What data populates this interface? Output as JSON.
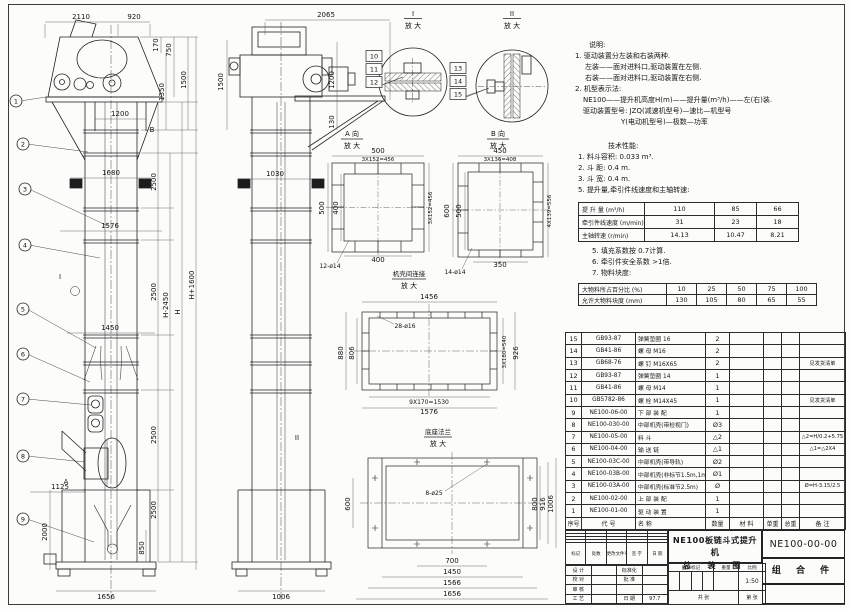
{
  "notes": {
    "title": "说明:",
    "lines": [
      {
        "t": "1. 驱动装置分左装和右装两种.",
        "i": 0
      },
      {
        "t": "左装——面对进料口,驱动装置在左侧.",
        "i": 10
      },
      {
        "t": "右装——面对进料口,驱动装置在右侧.",
        "i": 10
      },
      {
        "t": "2. 机型表示法:",
        "i": 0
      },
      {
        "t": "NE100——提升机高度H(m)——提升量(m³/h)——左(右)装.",
        "i": 8
      },
      {
        "t": "驱动装置型号: JZQ(减速机型号)—速比—机型号",
        "i": 8
      },
      {
        "t": "Y(电动机型号)—极数—功率",
        "i": 46
      }
    ]
  },
  "tech": {
    "title": "技术性能:",
    "lines_before": [
      {
        "t": "1. 料斗容积: 0.033 m³.",
        "i": 0
      },
      {
        "t": "2. 斗  距: 0.4 m.",
        "i": 0
      },
      {
        "t": "3. 斗  宽: 0.4 m.",
        "i": 0
      },
      {
        "t": "5. 提升量,牵引件线速度和主轴转速:",
        "i": 0
      }
    ],
    "lines_mid": [
      {
        "t": "5. 填充系数按 0.7计算.",
        "i": 0
      },
      {
        "t": "6. 牵引件安全系数 >1倍.",
        "i": 0
      },
      {
        "t": "7. 物料块度:",
        "i": 0
      }
    ]
  },
  "chart_data": [
    {
      "type": "table",
      "title": "提升量,牵引件线速度和主轴转速",
      "rows": [
        {
          "label": "提 升 量  (m³/h)",
          "values": [
            "110",
            "85",
            "66"
          ]
        },
        {
          "label": "牵引件线速度 (m/min)",
          "values": [
            "31",
            "23",
            "18"
          ]
        },
        {
          "label": "主轴转速  (r/min)",
          "values": [
            "14.13",
            "10.47",
            "8.21"
          ]
        }
      ]
    },
    {
      "type": "table",
      "title": "物料块度",
      "rows": [
        {
          "label": "大物料所占百分比 (%)",
          "values": [
            "10",
            "25",
            "50",
            "75",
            "100"
          ]
        },
        {
          "label": "允许大物料块度 (mm)",
          "values": [
            "130",
            "105",
            "80",
            "65",
            "55"
          ]
        }
      ]
    }
  ],
  "parts": {
    "headers": [
      "序号",
      "代  号",
      "名    称",
      "数量",
      "材  料",
      "单重",
      "总重",
      "备  注"
    ],
    "rows": [
      [
        "15",
        "GB93-87",
        "弹簧垫圈 16",
        "2",
        "",
        "",
        "",
        ""
      ],
      [
        "14",
        "GB41-86",
        "螺 母 M16",
        "2",
        "",
        "",
        "",
        ""
      ],
      [
        "13",
        "GB68-76",
        "螺 钉 M16X65",
        "2",
        "",
        "",
        "",
        "见发货清单"
      ],
      [
        "12",
        "GB93-87",
        "弹簧垫圈 14",
        "1",
        "",
        "",
        "",
        ""
      ],
      [
        "11",
        "GB41-86",
        "螺 母 M14",
        "1",
        "",
        "",
        "",
        ""
      ],
      [
        "10",
        "GB5782-86",
        "螺 栓 M14X45",
        "1",
        "",
        "",
        "",
        "见发货清单"
      ],
      [
        "9",
        "NE100-06-00",
        "下 部 装 配",
        "1",
        "",
        "",
        "",
        ""
      ],
      [
        "8",
        "NE100-030-00",
        "中部机壳(带检视门)",
        "Ø3",
        "",
        "",
        "",
        ""
      ],
      [
        "7",
        "NE100-05-00",
        "料  斗",
        "△2",
        "",
        "",
        "",
        "△2=H/0.2+5.75"
      ],
      [
        "6",
        "NE100-04-00",
        "输 送 链",
        "△1",
        "",
        "",
        "",
        "△1=△2X4"
      ],
      [
        "5",
        "NE100-03C-00",
        "中部机壳(带导轨)",
        "Ø2",
        "",
        "",
        "",
        ""
      ],
      [
        "4",
        "NE100-03B-00",
        "中部机壳(非标节1.5m,1m)",
        "Ø1",
        "",
        "",
        "",
        ""
      ],
      [
        "3",
        "NE100-03A-00",
        "中部机壳(标准节2.5m)",
        "Ø",
        "",
        "",
        "",
        "Ø=H-3.15/2.5"
      ],
      [
        "2",
        "NE100-02-00",
        "上 部 装 配",
        "1",
        "",
        "",
        "",
        ""
      ],
      [
        "1",
        "NE100-01-00",
        "驱 动 装 置",
        "1",
        "",
        "",
        "",
        ""
      ]
    ]
  },
  "titleblock": {
    "title_line1": "NE100板链斗式提升机",
    "title_line2": "总 装 图",
    "drawing_no": "NE100-00-00",
    "part_type": "组 合 件",
    "scale": "1:50",
    "rev_headers": [
      "标记",
      "处数",
      "更改文件号",
      "签 字",
      "日 期"
    ],
    "sig_rows": [
      [
        "设 计",
        "",
        "标准化",
        ""
      ],
      [
        "校 对",
        "",
        "批 准",
        ""
      ],
      [
        "审 核",
        "",
        "",
        ""
      ],
      [
        "工 艺",
        "",
        "日 期",
        "97.7"
      ]
    ],
    "mid_headers": [
      "图样标记",
      "重量",
      "比例"
    ],
    "sheet_total": "共  张",
    "sheet_no": "第  张"
  },
  "drawing": {
    "texts": [
      {
        "t": "2110",
        "x": 81,
        "y": 19
      },
      {
        "t": "920",
        "x": 134,
        "y": 19
      },
      {
        "t": "170",
        "x": 158,
        "y": 45,
        "r": -90
      },
      {
        "t": "750",
        "x": 171,
        "y": 50,
        "r": -90
      },
      {
        "t": "1350",
        "x": 164,
        "y": 92,
        "r": -90
      },
      {
        "t": "1500",
        "x": 186,
        "y": 80,
        "r": -90
      },
      {
        "t": "1200",
        "x": 120,
        "y": 116
      },
      {
        "t": "1680",
        "x": 111,
        "y": 175
      },
      {
        "t": "2500",
        "x": 156,
        "y": 182,
        "r": -90
      },
      {
        "t": "1576",
        "x": 110,
        "y": 228
      },
      {
        "t": "2500",
        "x": 156,
        "y": 292,
        "r": -90
      },
      {
        "t": "H-2450",
        "x": 168,
        "y": 305,
        "r": -90
      },
      {
        "t": "H",
        "x": 180,
        "y": 312,
        "r": -90
      },
      {
        "t": "H+1600",
        "x": 194,
        "y": 285,
        "r": -90
      },
      {
        "t": "1450",
        "x": 110,
        "y": 330
      },
      {
        "t": "2500",
        "x": 156,
        "y": 435,
        "r": -90
      },
      {
        "t": "2500",
        "x": 156,
        "y": 510,
        "r": -90
      },
      {
        "t": "1125",
        "x": 60,
        "y": 489
      },
      {
        "t": "2000",
        "x": 47,
        "y": 532,
        "r": -90
      },
      {
        "t": "850",
        "x": 144,
        "y": 548,
        "r": -90
      },
      {
        "t": "1656",
        "x": 106,
        "y": 599
      },
      {
        "t": "B",
        "x": 152,
        "y": 132
      },
      {
        "t": "A",
        "x": 66,
        "y": 484
      },
      {
        "t": "I",
        "x": 60,
        "y": 279
      },
      {
        "t": "2065",
        "x": 326,
        "y": 17
      },
      {
        "t": "1500",
        "x": 223,
        "y": 82,
        "r": -90
      },
      {
        "t": "1200",
        "x": 334,
        "y": 80,
        "r": -90
      },
      {
        "t": "130",
        "x": 334,
        "y": 122,
        "r": -90
      },
      {
        "t": "1030",
        "x": 275,
        "y": 176
      },
      {
        "t": "1006",
        "x": 281,
        "y": 599
      },
      {
        "t": "II",
        "x": 297,
        "y": 440
      },
      {
        "t": "I",
        "x": 413,
        "y": 16
      },
      {
        "t": "放 大",
        "x": 413,
        "y": 28
      },
      {
        "t": "II",
        "x": 512,
        "y": 16
      },
      {
        "t": "放 大",
        "x": 512,
        "y": 28
      },
      {
        "t": "A 向",
        "x": 352,
        "y": 136
      },
      {
        "t": "放 大",
        "x": 352,
        "y": 148
      },
      {
        "t": "B 向",
        "x": 498,
        "y": 136
      },
      {
        "t": "放 大",
        "x": 498,
        "y": 148
      },
      {
        "t": "机壳间连接",
        "x": 409,
        "y": 276,
        "fs": 6.5
      },
      {
        "t": "放 大",
        "x": 409,
        "y": 288
      },
      {
        "t": "底座法兰",
        "x": 438,
        "y": 434,
        "fs": 6.5
      },
      {
        "t": "放 大",
        "x": 438,
        "y": 446
      },
      {
        "t": "500",
        "x": 378,
        "y": 153
      },
      {
        "t": "3X152=456",
        "x": 378,
        "y": 161,
        "fs": 5.5
      },
      {
        "t": "500",
        "x": 324,
        "y": 208,
        "r": -90
      },
      {
        "t": "400",
        "x": 338,
        "y": 208,
        "r": -90
      },
      {
        "t": "3X152=456",
        "x": 432,
        "y": 208,
        "r": -90,
        "fs": 5.5
      },
      {
        "t": "400",
        "x": 378,
        "y": 262
      },
      {
        "t": "12-ø14",
        "x": 330,
        "y": 268,
        "fs": 6
      },
      {
        "t": "450",
        "x": 500,
        "y": 153
      },
      {
        "t": "3X136=408",
        "x": 500,
        "y": 161,
        "fs": 5.5
      },
      {
        "t": "600",
        "x": 449,
        "y": 211,
        "r": -90
      },
      {
        "t": "500",
        "x": 461,
        "y": 211,
        "r": -90
      },
      {
        "t": "4X139=556",
        "x": 551,
        "y": 211,
        "r": -90,
        "fs": 5.5
      },
      {
        "t": "350",
        "x": 500,
        "y": 267
      },
      {
        "t": "14-ø14",
        "x": 455,
        "y": 274,
        "fs": 6
      },
      {
        "t": "1456",
        "x": 429,
        "y": 299
      },
      {
        "t": "28-ø16",
        "x": 405,
        "y": 328,
        "fs": 6
      },
      {
        "t": "880",
        "x": 343,
        "y": 353,
        "r": -90
      },
      {
        "t": "806",
        "x": 354,
        "y": 353,
        "r": -90
      },
      {
        "t": "3X180=540",
        "x": 506,
        "y": 352,
        "r": -90,
        "fs": 5.5
      },
      {
        "t": "926",
        "x": 518,
        "y": 353,
        "r": -90
      },
      {
        "t": "9X170=1530",
        "x": 429,
        "y": 404,
        "fs": 6
      },
      {
        "t": "1576",
        "x": 429,
        "y": 414
      },
      {
        "t": "8-ø25",
        "x": 434,
        "y": 495,
        "fs": 6
      },
      {
        "t": "600",
        "x": 350,
        "y": 504,
        "r": -90
      },
      {
        "t": "800",
        "x": 537,
        "y": 504,
        "r": -90
      },
      {
        "t": "916",
        "x": 545,
        "y": 504,
        "r": -90
      },
      {
        "t": "1006",
        "x": 553,
        "y": 504,
        "r": -90
      },
      {
        "t": "700",
        "x": 452,
        "y": 563
      },
      {
        "t": "1450",
        "x": 452,
        "y": 574
      },
      {
        "t": "1566",
        "x": 452,
        "y": 585
      },
      {
        "t": "1656",
        "x": 452,
        "y": 596
      }
    ],
    "balloons": [
      {
        "n": "1",
        "x": 16,
        "y": 101,
        "lx": 46,
        "ly": 97
      },
      {
        "n": "2",
        "x": 23,
        "y": 144,
        "lx": 88,
        "ly": 152
      },
      {
        "n": "3",
        "x": 25,
        "y": 189,
        "lx": 108,
        "ly": 226
      },
      {
        "n": "4",
        "x": 25,
        "y": 245,
        "lx": 100,
        "ly": 258
      },
      {
        "n": "5",
        "x": 23,
        "y": 309,
        "lx": 96,
        "ly": 348
      },
      {
        "n": "6",
        "x": 23,
        "y": 354,
        "lx": 90,
        "ly": 382
      },
      {
        "n": "7",
        "x": 23,
        "y": 399,
        "lx": 91,
        "ly": 405
      },
      {
        "n": "8",
        "x": 23,
        "y": 456,
        "lx": 85,
        "ly": 462
      },
      {
        "n": "9",
        "x": 23,
        "y": 519,
        "lx": 94,
        "ly": 542
      }
    ],
    "refs": [
      {
        "n": "10",
        "x": 374,
        "y": 56
      },
      {
        "n": "11",
        "x": 374,
        "y": 69
      },
      {
        "n": "12",
        "x": 374,
        "y": 82
      },
      {
        "n": "13",
        "x": 458,
        "y": 68
      },
      {
        "n": "14",
        "x": 458,
        "y": 81
      },
      {
        "n": "15",
        "x": 458,
        "y": 94
      }
    ]
  }
}
